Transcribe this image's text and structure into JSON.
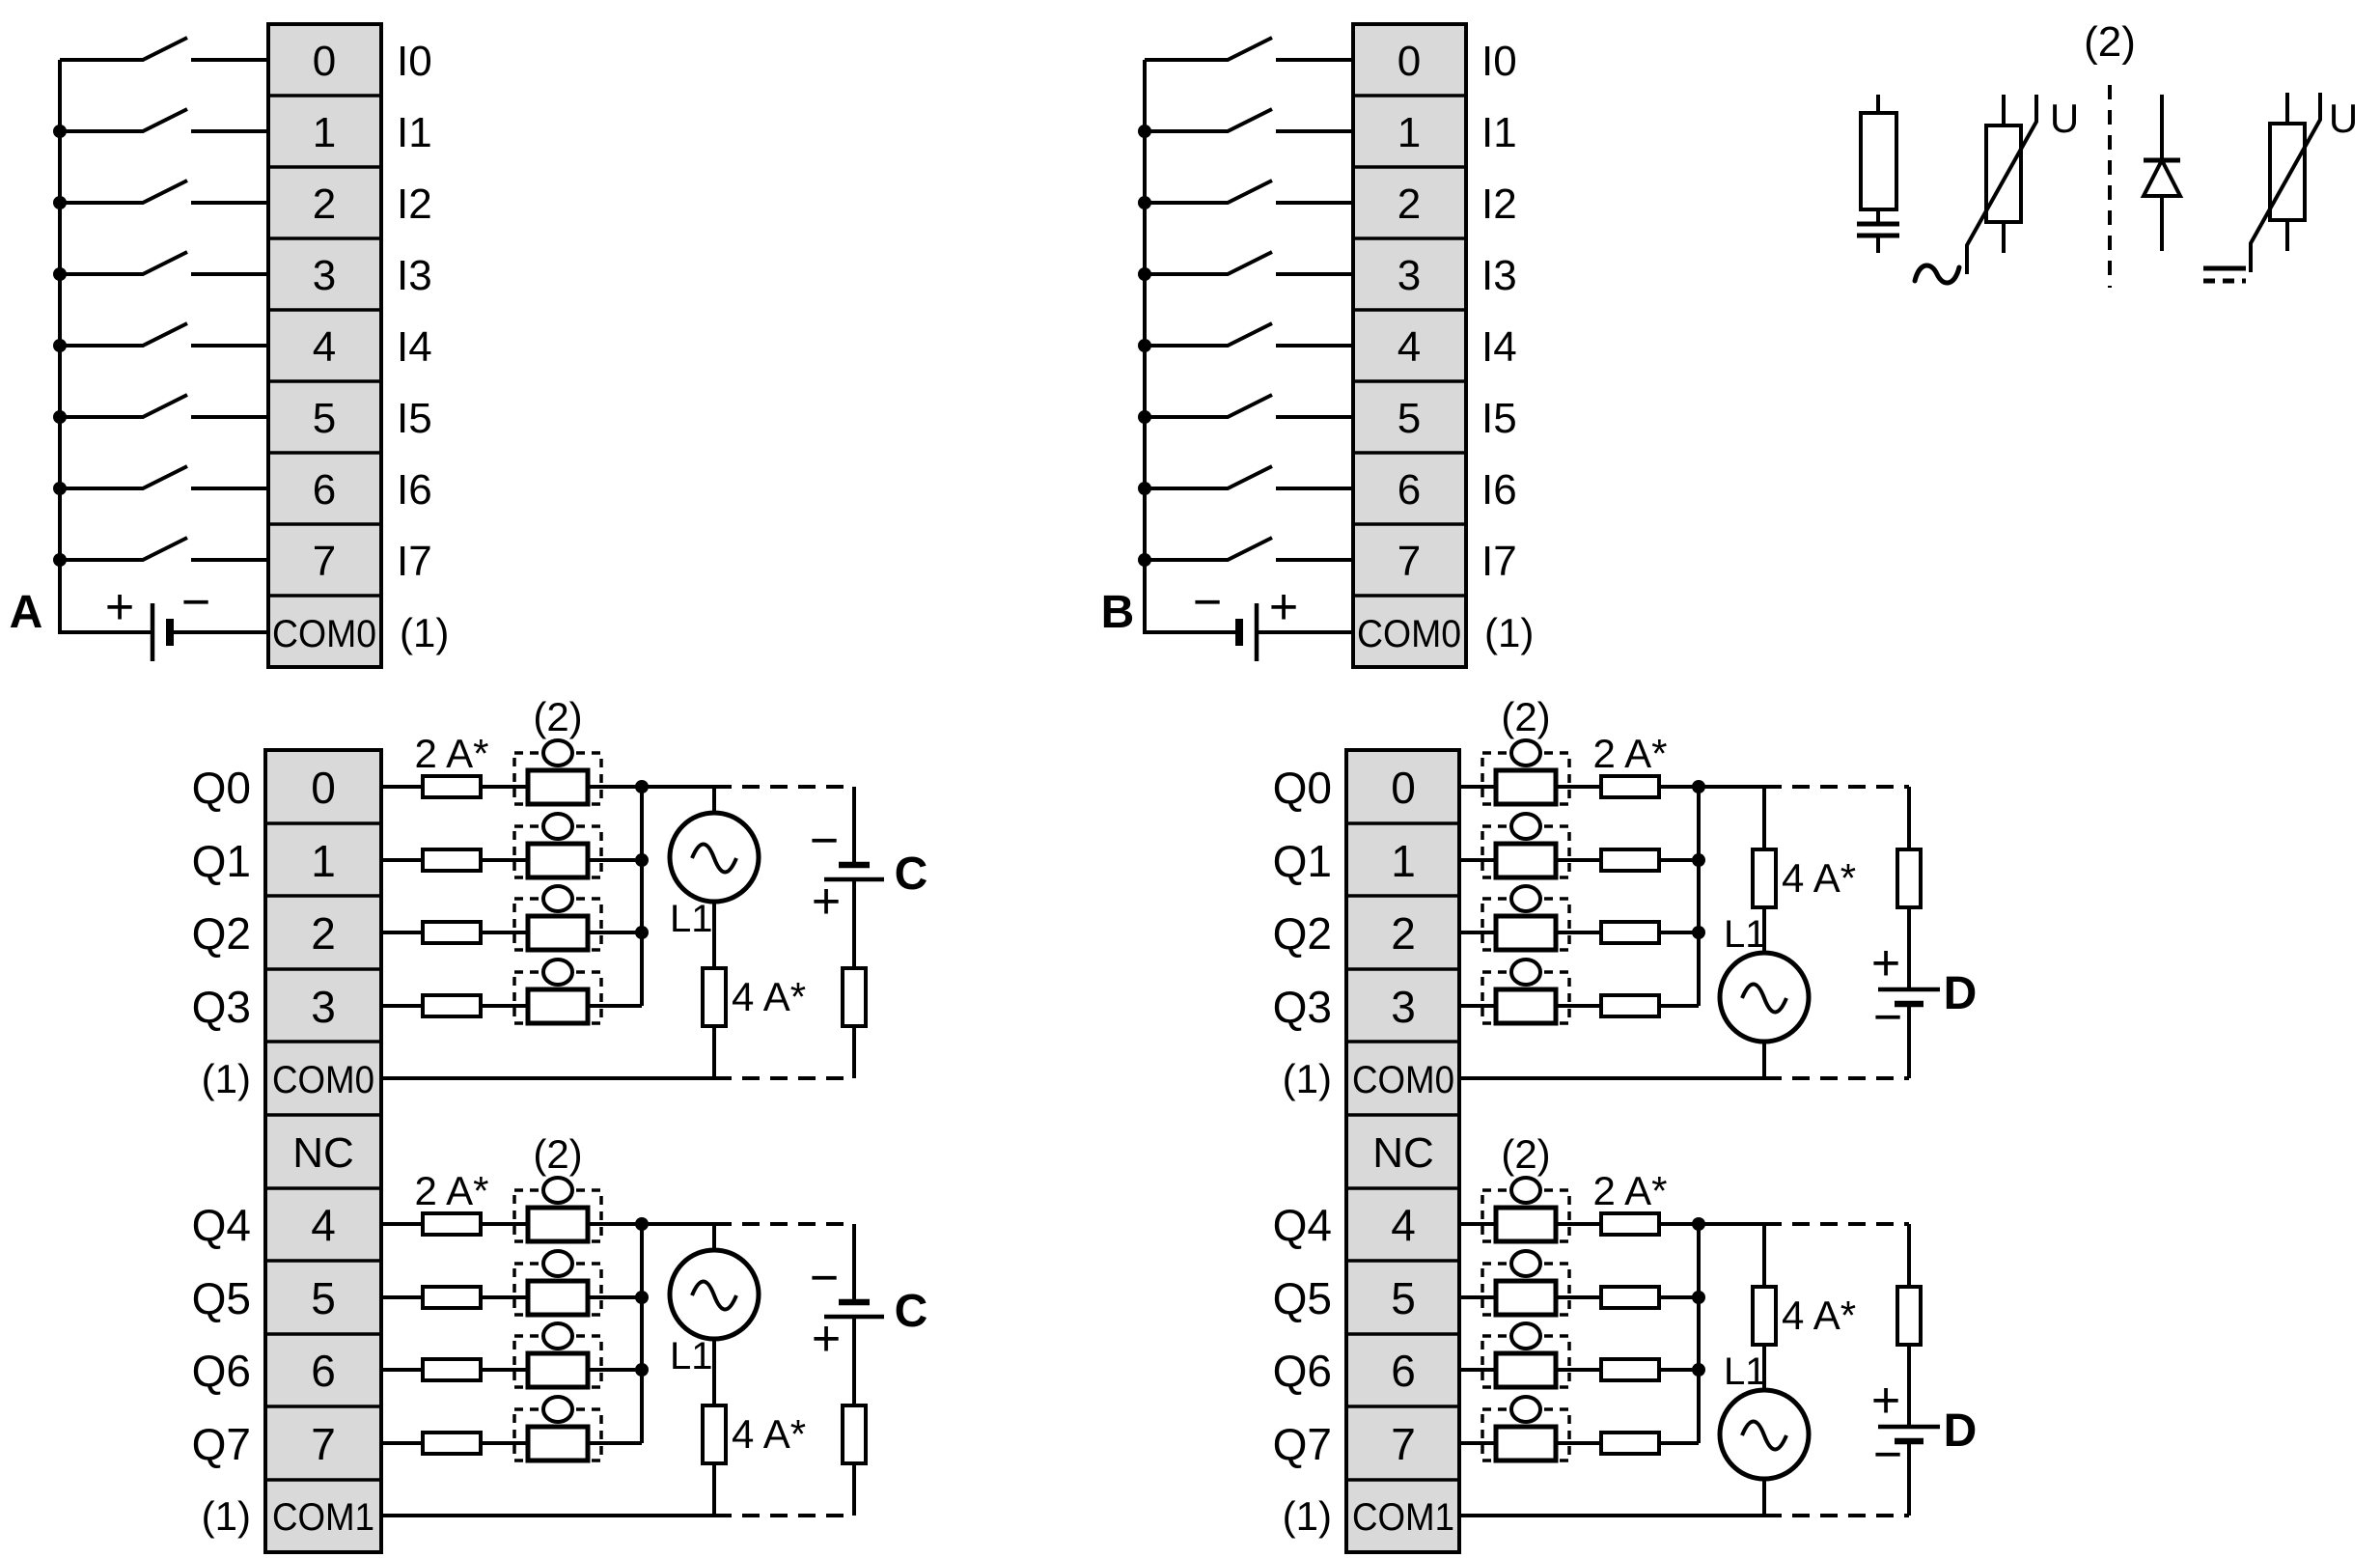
{
  "colors": {
    "ink": "#000000",
    "terminal_fill": "#d9d9d9",
    "background": "#ffffff"
  },
  "legend": {
    "title": "(2)",
    "ac_symbol": "~",
    "ac_varistor_label": "U",
    "dc_varistor_label": "U"
  },
  "input_a": {
    "label": "A",
    "plus": "+",
    "minus": "−",
    "terminals": [
      "0",
      "1",
      "2",
      "3",
      "4",
      "5",
      "6",
      "7",
      "COM0"
    ],
    "signals": [
      "I0",
      "I1",
      "I2",
      "I3",
      "I4",
      "I5",
      "I6",
      "I7"
    ],
    "com_note": "(1)"
  },
  "input_b": {
    "label": "B",
    "plus": "+",
    "minus": "−",
    "terminals": [
      "0",
      "1",
      "2",
      "3",
      "4",
      "5",
      "6",
      "7",
      "COM0"
    ],
    "signals": [
      "I0",
      "I1",
      "I2",
      "I3",
      "I4",
      "I5",
      "I6",
      "I7"
    ],
    "com_note": "(1)"
  },
  "output_left": {
    "sections": [
      {
        "channels": [
          "Q0",
          "Q1",
          "Q2",
          "Q3"
        ],
        "terminals": [
          "0",
          "1",
          "2",
          "3"
        ],
        "com": "COM0",
        "com_note": "(1)",
        "branch_fuse": "2 A*",
        "protection_note": "(2)",
        "line_fuse": "4 A*",
        "source": "L1",
        "supply": "C",
        "top_sign": "−",
        "bottom_sign": "+"
      },
      {
        "nc": "NC",
        "channels": [
          "Q4",
          "Q5",
          "Q6",
          "Q7"
        ],
        "terminals": [
          "4",
          "5",
          "6",
          "7"
        ],
        "com": "COM1",
        "com_note": "(1)",
        "branch_fuse": "2 A*",
        "protection_note": "(2)",
        "line_fuse": "4 A*",
        "source": "L1",
        "supply": "C",
        "top_sign": "−",
        "bottom_sign": "+"
      }
    ]
  },
  "output_right": {
    "sections": [
      {
        "channels": [
          "Q0",
          "Q1",
          "Q2",
          "Q3"
        ],
        "terminals": [
          "0",
          "1",
          "2",
          "3"
        ],
        "com": "COM0",
        "com_note": "(1)",
        "branch_fuse": "2 A*",
        "protection_note": "(2)",
        "line_fuse": "4 A*",
        "source": "L1",
        "supply": "D",
        "top_sign": "+",
        "bottom_sign": "−"
      },
      {
        "nc": "NC",
        "channels": [
          "Q4",
          "Q5",
          "Q6",
          "Q7"
        ],
        "terminals": [
          "4",
          "5",
          "6",
          "7"
        ],
        "com": "COM1",
        "com_note": "(1)",
        "branch_fuse": "2 A*",
        "protection_note": "(2)",
        "line_fuse": "4 A*",
        "source": "L1",
        "supply": "D",
        "top_sign": "+",
        "bottom_sign": "−"
      }
    ]
  }
}
